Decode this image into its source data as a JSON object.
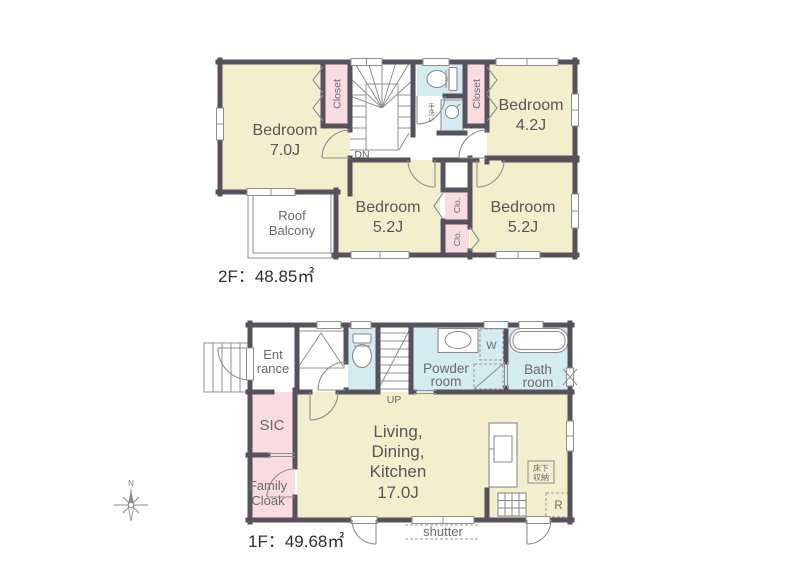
{
  "colors": {
    "wall": "#57515b",
    "room_cream": "#f2efcd",
    "closet_pink": "#f9dce2",
    "wet_blue": "#d5ebf2",
    "white": "#ffffff",
    "label_text": "#575757"
  },
  "floor2": {
    "title": "2F：48.85㎡",
    "bedroom1_name": "Bedroom",
    "bedroom1_size": "7.0J",
    "bedroom2_name": "Bedroom",
    "bedroom2_size": "4.2J",
    "bedroom3_name": "Bedroom",
    "bedroom3_size": "5.2J",
    "bedroom4_name": "Bedroom",
    "bedroom4_size": "5.2J",
    "closet_left": "Closet",
    "closet_right": "Closet",
    "clo_upper": "Clo.",
    "clo_lower": "Clo.",
    "hand_wash": "手洗い",
    "stairs_label": "DN",
    "balcony_line1": "Roof",
    "balcony_line2": "Balcony"
  },
  "floor1": {
    "title": "1F：49.68㎡",
    "entrance_line1": "Ent",
    "entrance_line2": "rance",
    "sic": "SIC",
    "cloak_line1": "Family",
    "cloak_line2": "Cloak",
    "powder_line1": "Powder",
    "powder_line2": "room",
    "bath_line1": "Bath",
    "bath_line2": "room",
    "ldk_line1": "Living,",
    "ldk_line2": "Dining,",
    "ldk_line3": "Kitchen",
    "ldk_line4": "17.0J",
    "stairs_label": "UP",
    "washer": "W",
    "fridge": "R",
    "floor_storage_line1": "床下",
    "floor_storage_line2": "収納",
    "shutter": "shutter"
  },
  "compass": {
    "north": "N"
  }
}
